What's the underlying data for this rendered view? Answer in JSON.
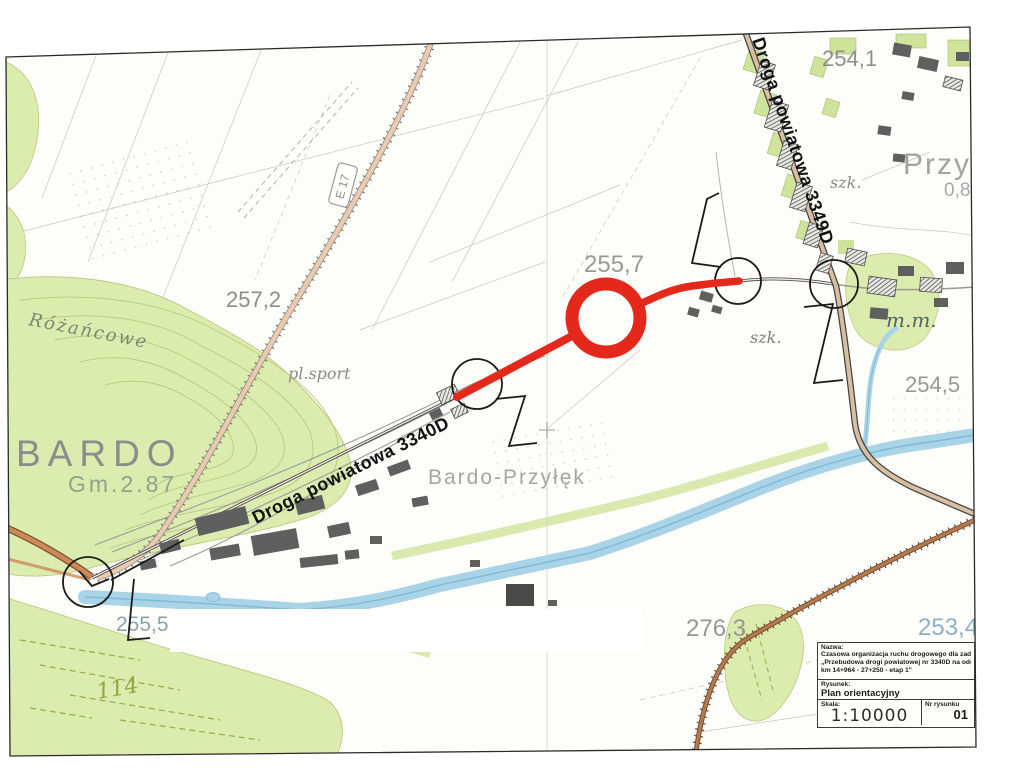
{
  "map": {
    "labels": {
      "bardo": "BARDO",
      "bardo_gm": "Gm.2.87",
      "rozancowe": "Różańcowe",
      "bardo_przylek": "Bardo-Przyłęk",
      "pl_sport": "pl.sport",
      "przylek": "Przyłęk",
      "szk_top": "szk.",
      "szk_mid": "szk.",
      "mm": "m.m.",
      "elev_254_1": "254,1",
      "elev_255_7": "255,7",
      "elev_257_2": "257,2",
      "elev_254_5": "254,5",
      "elev_255_5": "255,5",
      "elev_276_3": "276,3",
      "elev_253_4": "253,4",
      "elev_0_8": "0,8",
      "field_114": "114",
      "road_3340d": "Droga powiatowa 3340D",
      "road_3349d": "Droga powiatowa 3349D",
      "road_shield": "E 17"
    },
    "colors": {
      "route_highlight": "#e5281c",
      "forest_green": "#dcecae",
      "water_blue": "#a9d3e6",
      "road_tan": "#d7bfa4"
    }
  },
  "title_block": {
    "nazwa_label": "Nazwa:",
    "nazwa_line1": "Czasowa organizacja ruchu drogowego dla zadania pn.:",
    "nazwa_line2": "„Przebudowa drogi powiatowej nr 3340D na odcinku Bardo - Przyłęk",
    "nazwa_line3": "km 14+964 - 27+250 - etap 1\"",
    "rysunek_label": "Rysunek:",
    "rysunek_value": "Plan orientacyjny",
    "skala_label": "Skala:",
    "skala_value": "1:10000",
    "nr_label": "Nr rysunku",
    "nr_value": "01"
  }
}
